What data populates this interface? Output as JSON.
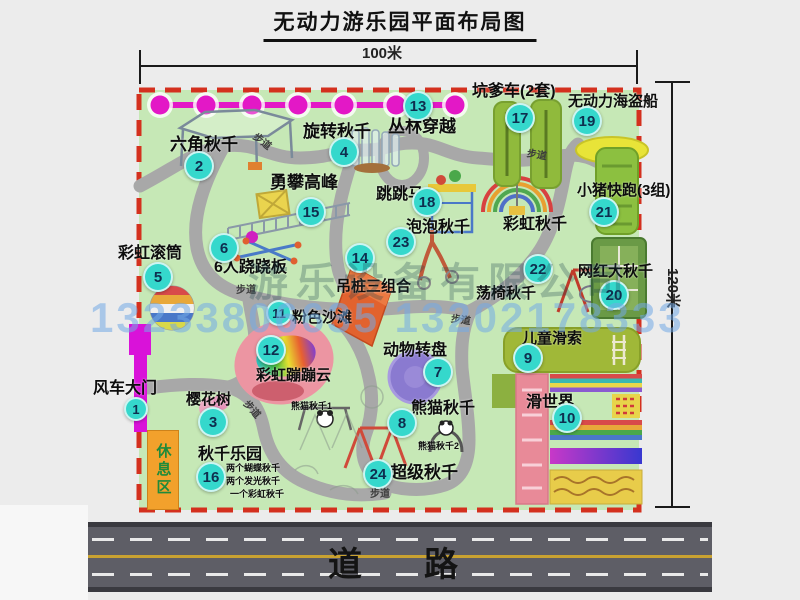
{
  "title": "无动力游乐园平面布局图",
  "dimensions": {
    "top": "100米",
    "right": "120米"
  },
  "watermark": {
    "company": "游乐设备有限公司",
    "phone": "13233806635 13202178333"
  },
  "road": {
    "label": "道　路"
  },
  "rest_area": {
    "label": "休息区"
  },
  "colors": {
    "map_fill": "#c6e8b6",
    "boundary_dashed": "#d4301e",
    "path_gray": "#a8a8a8",
    "badge_cyan": "#35d8cc",
    "zipline_magenta": "#e318c6",
    "gate_magenta": "#d912d9",
    "rest_area_orange": "#f2a12c",
    "road_gray": "#5e5e66",
    "road_line_yellow": "#c9a231"
  },
  "attractions": [
    {
      "num": 1,
      "name": "风车大门",
      "label": {
        "x": 93,
        "y": 380,
        "size": 16
      },
      "badge": {
        "x": 136,
        "y": 409,
        "r": 12
      }
    },
    {
      "num": 2,
      "name": "六角秋千",
      "label": {
        "x": 170,
        "y": 136,
        "size": 17
      },
      "badge": {
        "x": 199,
        "y": 166,
        "r": 15
      }
    },
    {
      "num": 3,
      "name": "樱花树",
      "label": {
        "x": 186,
        "y": 392,
        "size": 15
      },
      "badge": {
        "x": 213,
        "y": 422,
        "r": 15
      }
    },
    {
      "num": 4,
      "name": "旋转秋千",
      "label": {
        "x": 303,
        "y": 123,
        "size": 17
      },
      "badge": {
        "x": 344,
        "y": 152,
        "r": 15
      }
    },
    {
      "num": 5,
      "name": "彩虹滚筒",
      "label": {
        "x": 118,
        "y": 245,
        "size": 16
      },
      "badge": {
        "x": 158,
        "y": 277,
        "r": 15
      }
    },
    {
      "num": 6,
      "name": "6人跷跷板",
      "label": {
        "x": 214,
        "y": 259,
        "size": 16
      },
      "badge": {
        "x": 224,
        "y": 248,
        "r": 15
      }
    },
    {
      "num": 7,
      "name": "动物转盘",
      "label": {
        "x": 383,
        "y": 342,
        "size": 16
      },
      "badge": {
        "x": 438,
        "y": 372,
        "r": 15
      }
    },
    {
      "num": 8,
      "name": "熊猫秋千",
      "label": {
        "x": 411,
        "y": 400,
        "size": 16
      },
      "badge": {
        "x": 402,
        "y": 423,
        "r": 15
      }
    },
    {
      "num": 9,
      "name": "儿童滑索",
      "label": {
        "x": 522,
        "y": 331,
        "size": 15
      },
      "badge": {
        "x": 528,
        "y": 358,
        "r": 15
      }
    },
    {
      "num": 10,
      "name": "滑世界",
      "label": {
        "x": 526,
        "y": 394,
        "size": 16
      },
      "badge": {
        "x": 567,
        "y": 418,
        "r": 15
      }
    },
    {
      "num": 11,
      "name": "粉色沙滩",
      "label": {
        "x": 292,
        "y": 310,
        "size": 15
      },
      "badge": {
        "x": 279,
        "y": 313,
        "r": 13
      }
    },
    {
      "num": 12,
      "name": "彩虹蹦蹦云",
      "label": {
        "x": 256,
        "y": 368,
        "size": 15
      },
      "badge": {
        "x": 271,
        "y": 350,
        "r": 15
      }
    },
    {
      "num": 13,
      "name": "丛林穿越",
      "label": {
        "x": 388,
        "y": 118,
        "size": 17
      },
      "badge": {
        "x": 418,
        "y": 106,
        "r": 15
      }
    },
    {
      "num": 14,
      "name": "吊桩三组合",
      "label": {
        "x": 336,
        "y": 279,
        "size": 15
      },
      "badge": {
        "x": 360,
        "y": 258,
        "r": 15
      }
    },
    {
      "num": 15,
      "name": "勇攀高峰",
      "label": {
        "x": 270,
        "y": 174,
        "size": 17
      },
      "badge": {
        "x": 311,
        "y": 212,
        "r": 15
      }
    },
    {
      "num": 16,
      "name": "秋千乐园",
      "label": {
        "x": 198,
        "y": 446,
        "size": 16
      },
      "badge": {
        "x": 211,
        "y": 477,
        "r": 15
      }
    },
    {
      "num": 17,
      "name": "坑爹车(2套)",
      "label": {
        "x": 472,
        "y": 83,
        "size": 16
      },
      "badge": {
        "x": 520,
        "y": 118,
        "r": 15
      }
    },
    {
      "num": 18,
      "name": "跳跳马",
      "label": {
        "x": 376,
        "y": 186,
        "size": 16
      },
      "badge": {
        "x": 427,
        "y": 202,
        "r": 15
      }
    },
    {
      "num": 19,
      "name": "无动力海盗船",
      "label": {
        "x": 568,
        "y": 94,
        "size": 15
      },
      "badge": {
        "x": 587,
        "y": 121,
        "r": 15
      }
    },
    {
      "num": 20,
      "name": "网红大秋千",
      "label": {
        "x": 578,
        "y": 264,
        "size": 15
      },
      "badge": {
        "x": 614,
        "y": 295,
        "r": 15
      }
    },
    {
      "num": 21,
      "name": "小猪快跑(3组)",
      "label": {
        "x": 577,
        "y": 183,
        "size": 15
      },
      "badge": {
        "x": 604,
        "y": 212,
        "r": 15
      }
    },
    {
      "num": 22,
      "name": "荡椅秋千",
      "label": {
        "x": 476,
        "y": 286,
        "size": 15
      },
      "badge": {
        "x": 538,
        "y": 269,
        "r": 15
      }
    },
    {
      "num": 23,
      "name": "泡泡秋千",
      "label": {
        "x": 406,
        "y": 219,
        "size": 16
      },
      "badge": {
        "x": 401,
        "y": 242,
        "r": 15
      }
    },
    {
      "num": 24,
      "name": "超级秋千",
      "label": {
        "x": 390,
        "y": 464,
        "size": 17
      },
      "badge": {
        "x": 378,
        "y": 474,
        "r": 15
      }
    }
  ],
  "extra_labels": [
    {
      "text": "彩虹秋千",
      "x": 503,
      "y": 216,
      "size": 16
    },
    {
      "text": "熊猫秋千1",
      "x": 291,
      "y": 402,
      "size": 9
    },
    {
      "text": "熊猫秋千2",
      "x": 418,
      "y": 442,
      "size": 9
    },
    {
      "text": "两个蝴蝶秋千",
      "x": 226,
      "y": 464,
      "size": 9
    },
    {
      "text": "两个发光秋千",
      "x": 226,
      "y": 477,
      "size": 9
    },
    {
      "text": "一个彩虹秋千",
      "x": 230,
      "y": 490,
      "size": 9
    }
  ],
  "trail_labels": [
    {
      "text": "步道",
      "x": 253,
      "y": 133,
      "rot": 38
    },
    {
      "text": "步道",
      "x": 527,
      "y": 146,
      "rot": 10
    },
    {
      "text": "步道",
      "x": 236,
      "y": 281,
      "rot": 0
    },
    {
      "text": "步道",
      "x": 451,
      "y": 311,
      "rot": 8
    },
    {
      "text": "步道",
      "x": 243,
      "y": 401,
      "rot": 48
    },
    {
      "text": "步道",
      "x": 370,
      "y": 485,
      "rot": 0
    }
  ]
}
